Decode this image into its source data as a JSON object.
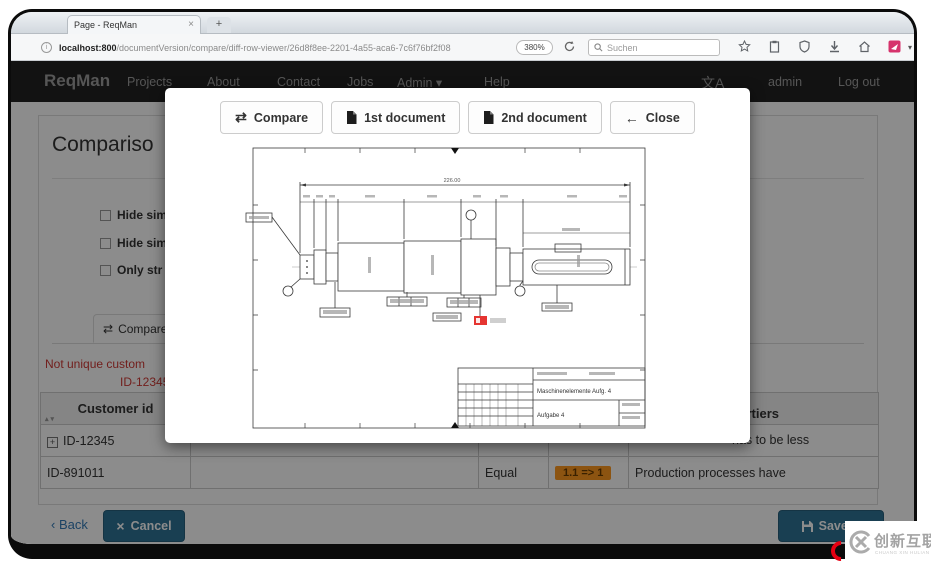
{
  "browser": {
    "tab_title": "Page - ReqMan",
    "url_host": "localhost:800",
    "url_path": "/documentVersion/compare/diff-row-viewer/26d8f8ee-2201-4a55-aca6-7c6f76bf2f08",
    "zoom_level": "380%",
    "search_placeholder": "Suchen",
    "action_icons": [
      "bookmark-star",
      "clipboard",
      "shield",
      "download",
      "home",
      "screenshot-extension"
    ]
  },
  "navbar": {
    "brand": "ReqMan",
    "items": [
      "Projects",
      "About",
      "Contact",
      "Jobs",
      "Admin",
      "Help"
    ],
    "user": "admin",
    "logout": "Log out"
  },
  "page": {
    "heading": "Compariso",
    "checkboxes": [
      "Hide sim",
      "Hide sim",
      "Only str"
    ],
    "compare_tab": "Compare",
    "error_line1": "Not unique custom",
    "error_line2": "ID-12345",
    "table": {
      "header_customer_id": "Customer id",
      "header_fragment": "vertiers",
      "row1_id": "ID-12345",
      "row1_fragment": "has to be less",
      "row2_id": "ID-891011",
      "row2_status": "Equal",
      "row2_badge": "1.1 => 1",
      "row2_fragment": "Production processes have"
    },
    "footer": {
      "back": "Back",
      "cancel": "Cancel",
      "save": "Save R"
    }
  },
  "modal": {
    "buttons": [
      {
        "label": "Compare"
      },
      {
        "label": "1st document"
      },
      {
        "label": "2nd document"
      },
      {
        "label": "Close"
      }
    ],
    "drawing": {
      "overall_dimension": "226.00",
      "title_line1": "Maschinenelemente Aufg. 4",
      "title_line2": "Aufgabe 4"
    }
  },
  "watermark": {
    "logo_text": "创新互联",
    "subtext": "CHUANG XIN HULIAN"
  }
}
